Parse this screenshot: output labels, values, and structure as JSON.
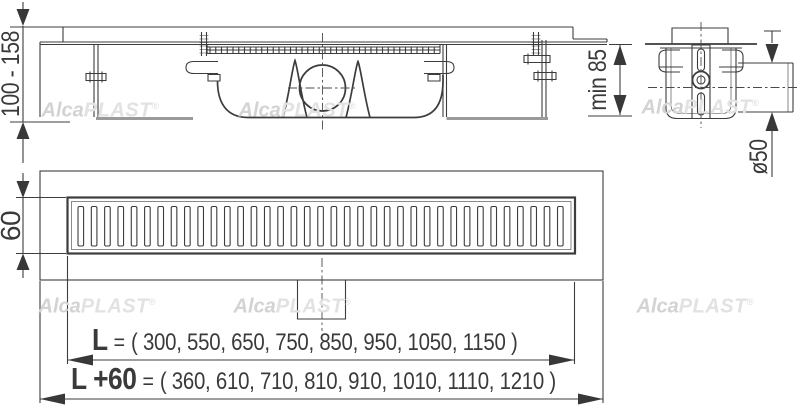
{
  "drawing": {
    "description": "AlcaPlast shower drain channel installation drawing",
    "colors": {
      "line": "#3c3c3c",
      "light_line": "#9a9a9a",
      "watermark": "#d8d8d8"
    }
  },
  "watermark": {
    "bold": "Alca",
    "light": "PLAST",
    "reg": "®"
  },
  "dims": {
    "install_height": "100 - 158",
    "min_depth": "min 85",
    "outlet_diameter": "ø50",
    "grate_width": "60",
    "l_label": "L",
    "l_eq": "=",
    "l_values": "( 300, 550, 650, 750, 850, 950, 1050, 1150 )",
    "l60_label": "L +60",
    "l60_eq": "=",
    "l60_values": "( 360, 610, 710, 810, 910, 1010, 1110, 1210 )"
  }
}
